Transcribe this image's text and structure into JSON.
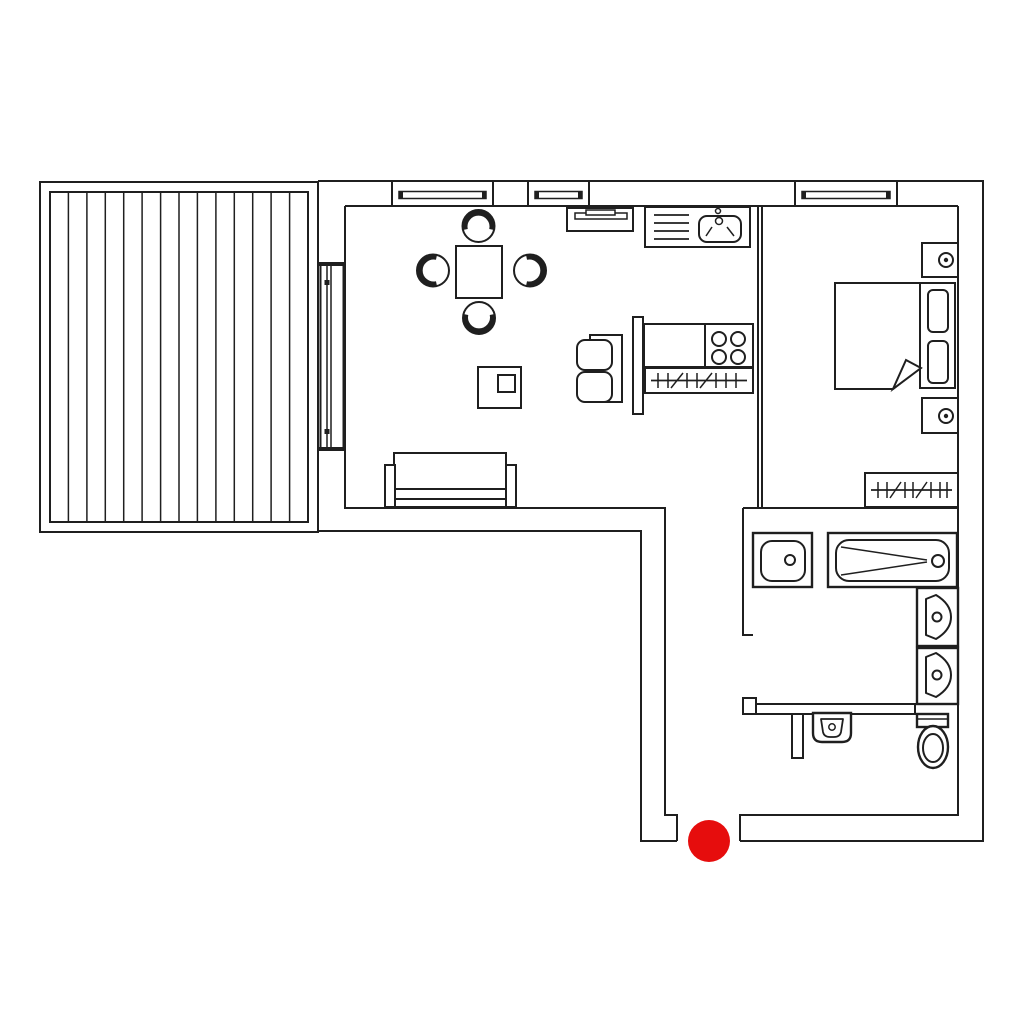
{
  "canvas": {
    "width": 1024,
    "height": 1024
  },
  "colors": {
    "background": "#ffffff",
    "line": "#1f1f1f",
    "fixture_fill": "#ffffff",
    "marker": "#e60d0d"
  },
  "marker": {
    "shape": "circle",
    "x": 709,
    "y": 841,
    "r": 21
  },
  "fixtures": [
    {
      "name": "deck-terrace",
      "count": 1
    },
    {
      "name": "sliding-door",
      "count": 1
    },
    {
      "name": "window",
      "count": 3
    },
    {
      "name": "dining-table",
      "count": 1
    },
    {
      "name": "dining-chair",
      "count": 4
    },
    {
      "name": "sofa",
      "count": 1
    },
    {
      "name": "loveseat",
      "count": 1
    },
    {
      "name": "side-table",
      "count": 1
    },
    {
      "name": "wall-shelf",
      "count": 1
    },
    {
      "name": "kitchen-sink-counter",
      "count": 1
    },
    {
      "name": "stove-counter",
      "count": 1
    },
    {
      "name": "radiator",
      "count": 2
    },
    {
      "name": "half-wall",
      "count": 1
    },
    {
      "name": "double-bed",
      "count": 1
    },
    {
      "name": "pillow",
      "count": 2
    },
    {
      "name": "nightstand",
      "count": 2
    },
    {
      "name": "shower-tray",
      "count": 1
    },
    {
      "name": "bathtub",
      "count": 1
    },
    {
      "name": "washbasin",
      "count": 2
    },
    {
      "name": "wc-washbasin",
      "count": 1
    },
    {
      "name": "toilet",
      "count": 1
    },
    {
      "name": "red-dot-marker",
      "count": 1
    }
  ]
}
